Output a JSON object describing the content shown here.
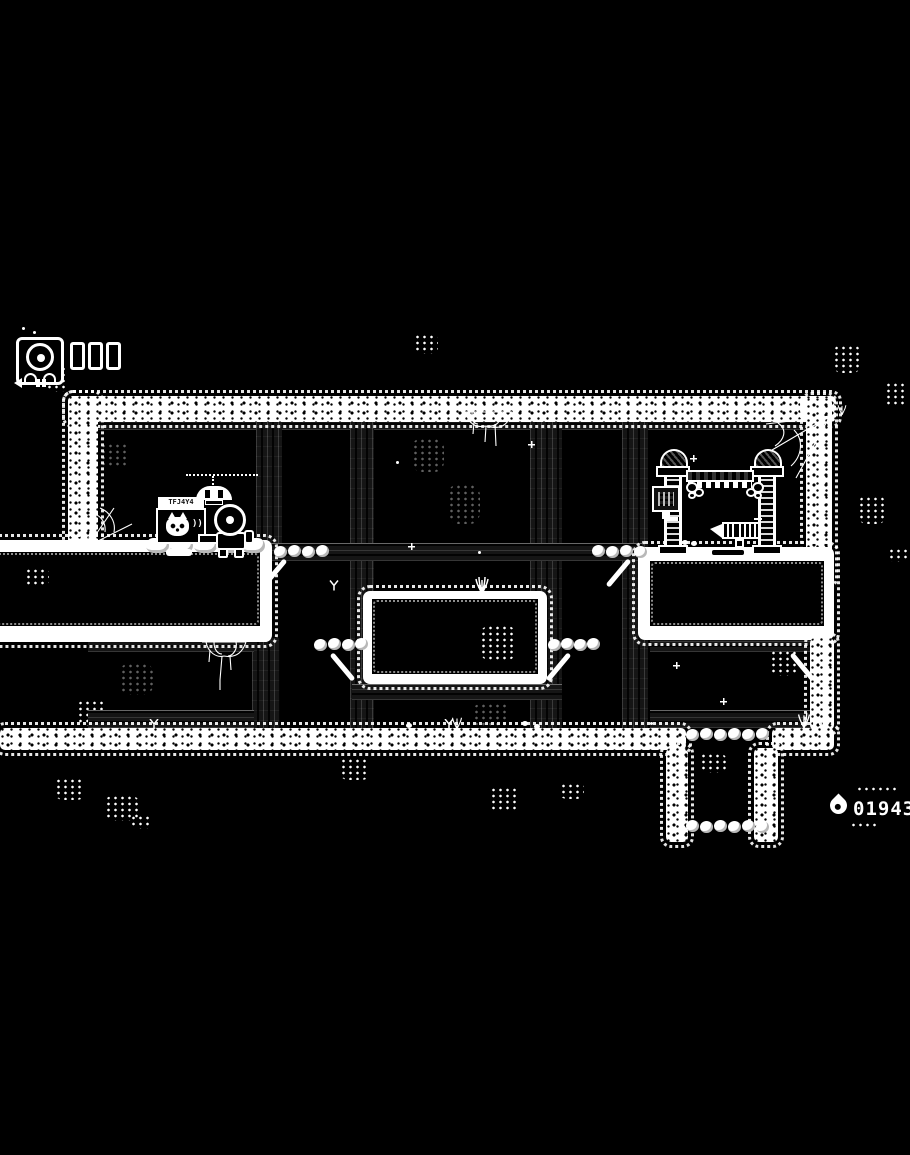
{
  "hud": {
    "portrait_icon": "mech-helmet-icon",
    "health_cells": 3,
    "weapon_icon": "dart-projectile-icon"
  },
  "resource_counter": {
    "icon": "water-drop-icon",
    "value": "01943"
  },
  "sign": {
    "header_glyphs": "TFJ4Y4",
    "panel_icon": "cat-face-icon",
    "sound_wave_glyph": "))"
  },
  "colors": {
    "background": "#000000",
    "foreground": "#ffffff",
    "wood_beam": "#1b1b1b"
  },
  "scene": {
    "player": "cat-mech",
    "props": [
      "hanging-lamp",
      "info-sign",
      "gate-structure",
      "wall-monitor",
      "mine-cart",
      "steam-puffs",
      "cobwebs",
      "grass-tufts",
      "pebble-platforms",
      "root-spikes"
    ]
  }
}
